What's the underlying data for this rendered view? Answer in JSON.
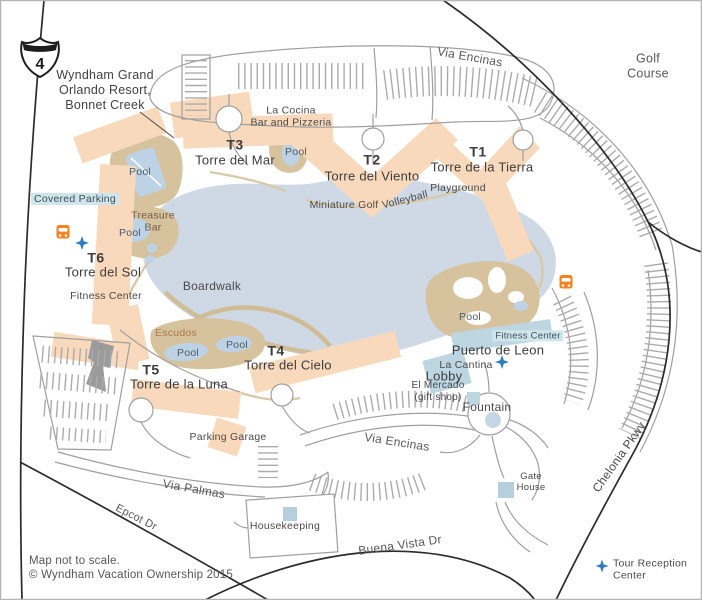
{
  "map_title": "Wyndham Grand\nOrlando Resort,\nBonnet Creek",
  "interstate": {
    "number": "4"
  },
  "labels": {
    "resort_name": "Wyndham Grand\nOrlando Resort,\nBonnet Creek",
    "golf_course": "Golf Course",
    "via_encinas_top": "Via Encinas",
    "via_encinas_bottom": "Via Encinas",
    "la_cocina": "La Cocina\nBar and Pizzeria",
    "t3_code": "T3",
    "t3_name": "Torre del Mar",
    "t2_code": "T2",
    "t2_name": "Torre del Viento",
    "t1_code": "T1",
    "t1_name": "Torre de la Tierra",
    "t6_code": "T6",
    "t6_name": "Torre del Sol",
    "t5_code": "T5",
    "t5_name": "Torre de la Luna",
    "t4_code": "T4",
    "t4_name": "Torre del Cielo",
    "playground": "Playground",
    "miniature_golf": "Miniature Golf",
    "volleyball": "Volleyball",
    "covered_parking": "Covered Parking",
    "treasure_bar": "Treasure\nBar",
    "pool_upper_west": "Pool",
    "pool_treasure": "Pool",
    "pool_t3": "Pool",
    "pool_escudos_west": "Pool",
    "pool_escudos_east": "Pool",
    "pool_east": "Pool",
    "fitness_center_west": "Fitness Center",
    "fitness_center_east": "Fitness Center",
    "boardwalk": "Boardwalk",
    "escudos": "Escudos",
    "parking_garage": "Parking Garage",
    "via_palmas": "Via Palmas",
    "epcot_dr": "Epcot Dr",
    "housekeeping": "Housekeeping",
    "buena_vista_dr": "Buena Vista Dr",
    "fountain": "Fountain",
    "el_mercado": "El Mercado\n(gift shop)",
    "lobby": "Lobby",
    "la_cantina": "La Cantina",
    "puerto_de_leon": "Puerto de Leon",
    "gate_house": "Gate\nHouse",
    "chelonia_pkwy": "Chelonia Pkwy",
    "map_scale_note": "Map not to scale.",
    "copyright": "© Wyndham Vacation Ownership 2015",
    "tour_reception_center": "Tour Reception\nCenter"
  },
  "colors": {
    "building": "#f8d9bc",
    "pool_deck": "#d6c29c",
    "lake": "#ced9e5",
    "pool_water": "#bdd2e4",
    "blue_building": "#bdd6e2",
    "marker_square": "#b5d0dc",
    "highlight": "#cfe5ec",
    "bus_orange": "#f58220",
    "star_blue": "#2e7cba",
    "road_gray": "#9f9f9f",
    "major_road_black": "#2b2b2b"
  }
}
